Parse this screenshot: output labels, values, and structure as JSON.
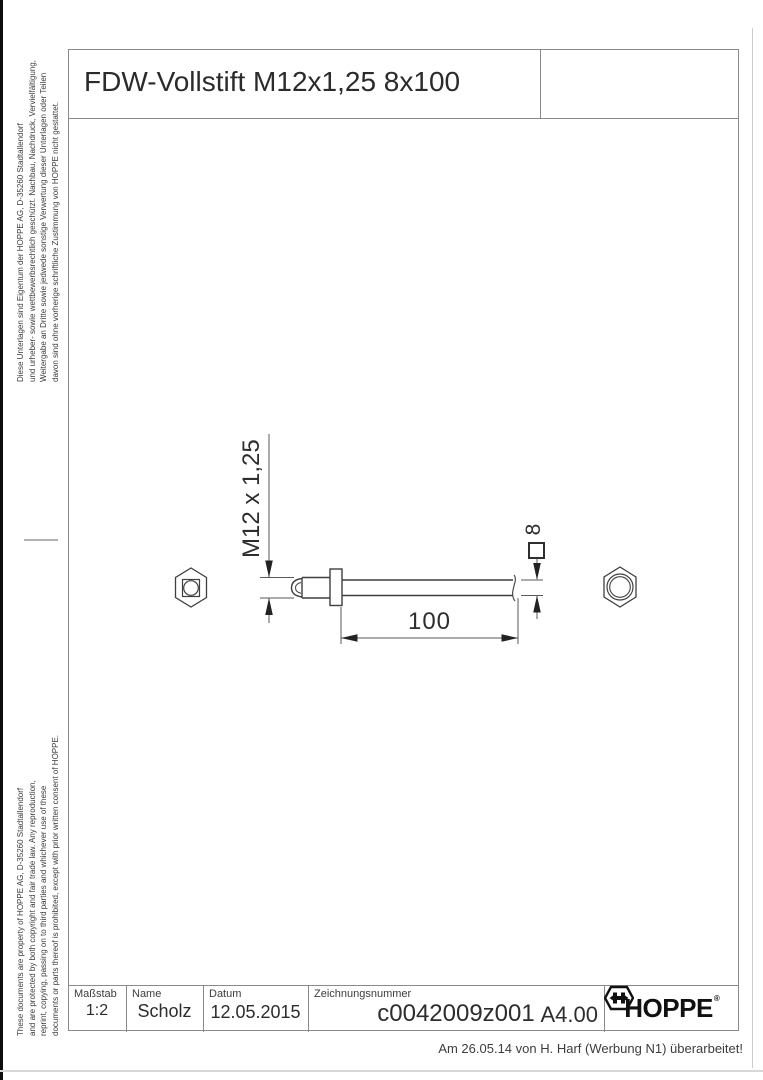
{
  "header": {
    "title": "FDW-Vollstift M12x1,25 8x100"
  },
  "legal_de": {
    "lines": [
      "Diese Unterlagen sind Eigentum der  HOPPE AG, D-35260 Stadtallendorf",
      "und urheber- sowie wettbewerbsrechtlich geschützt. Nachbau, Nachdruck, Vervielfältigung,",
      "Weitergabe an Dritte sowie jedwede sonstige Verwertung dieser Unterlagen oder Teilen",
      "davon sind ohne vorherige schriftliche Zustimmung von HOPPE nicht gestattet."
    ]
  },
  "legal_en": {
    "lines": [
      "These documents are property of  HOPPE AG, D-35260 Stadtallendorf",
      "and are protected by both copyright and fair trade law. Any reproduction,",
      "reprint, copying, passing on to third parties and whichever use of these",
      "documents or parts thereof is prohibited, except with prior written consent of  HOPPE."
    ]
  },
  "drawing": {
    "thread_dimension": "M12 x 1,25",
    "length_dimension": "100",
    "square_dimension": "8"
  },
  "title_block": {
    "scale_label": "Maßstab",
    "scale_value": "1:2",
    "name_label": "Name",
    "name_value": "Scholz",
    "date_label": "Datum",
    "date_value": "12.05.2015",
    "number_label": "Zeichnungsnummer",
    "number_value": "c0042009z001",
    "format_value": "A4.00",
    "logo_text": "HOPPE",
    "logo_reg": "®"
  },
  "footer": {
    "revision_note": "Am 26.05.14 von H. Harf (Werbung N1) überarbeitet!"
  },
  "colors": {
    "frame_line": "#8a8a8a",
    "part_line": "#3f3f3f",
    "dim_line": "#5a5a5a",
    "text": "#2d2d2d",
    "logo": "#111111"
  }
}
